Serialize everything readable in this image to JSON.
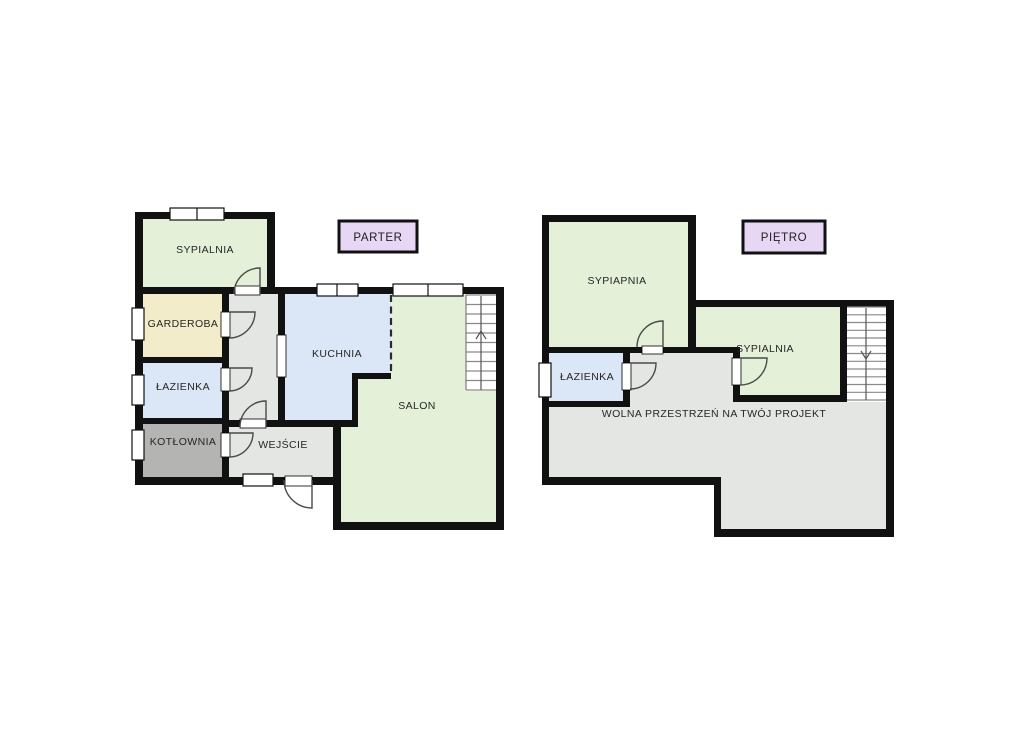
{
  "floors": [
    {
      "title": "PARTER",
      "rooms": [
        "SYPIALNIA",
        "GARDEROBA",
        "ŁAZIENKA",
        "KOTŁOWNIA",
        "KUCHNIA",
        "WEJŚCIE",
        "SALON"
      ],
      "stairs_direction": "up"
    },
    {
      "title": "PIĘTRO",
      "rooms": [
        "SYPIAPNIA",
        "ŁAZIENKA",
        "SYPIALNIA",
        "WOLNA PRZESTRZEŃ NA TWÓJ PROJEKT"
      ],
      "stairs_direction": "down"
    }
  ],
  "colors": {
    "room_green": "#e4f0d8",
    "room_blue": "#dbe7f6",
    "room_beige": "#f3ecca",
    "room_dark_gray": "#b4b4b2",
    "room_light_gray": "#e3e6e2",
    "floor_label_purple": "#e8d6f5",
    "wall_black": "#111111"
  }
}
